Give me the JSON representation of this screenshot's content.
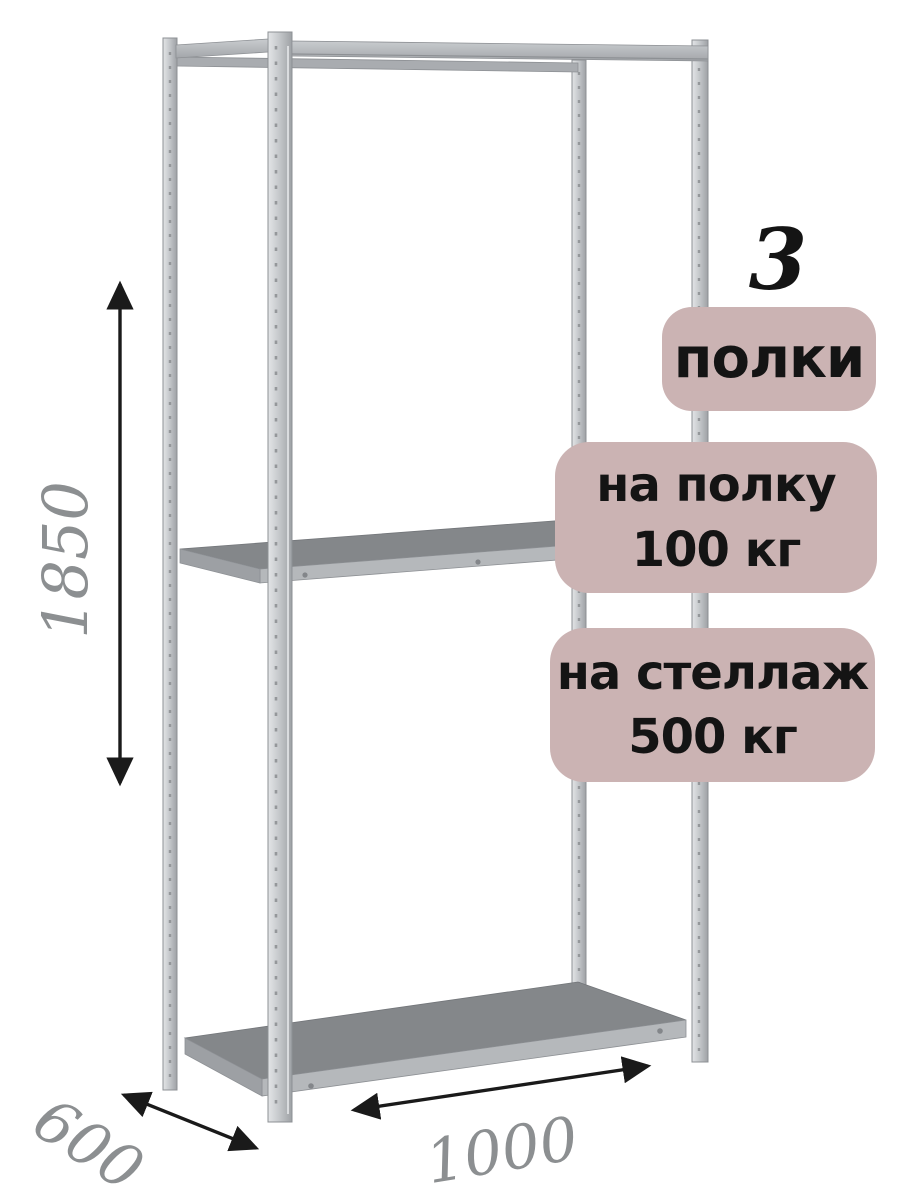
{
  "badges": {
    "count_number": "3",
    "count_label": "полки",
    "per_shelf": {
      "line1": "на полку",
      "line2": "100 кг"
    },
    "per_rack": {
      "line1": "на стеллаж",
      "line2": "500 кг"
    }
  },
  "dimensions": {
    "height_mm": "1850",
    "width_mm": "1000",
    "depth_mm": "600"
  },
  "colors": {
    "background": "#ffffff",
    "badge_bg": "#cbb3b3",
    "badge_text": "#141414",
    "count_number_color": "#141414",
    "dimension_text": "#8c8f91",
    "arrow": "#1a1a1a",
    "metal_light": "#d7d9db",
    "metal_mid": "#b7babd",
    "metal_dark": "#979a9d",
    "shelf_top": "#84878a",
    "shelf_front": "#b5b8bb"
  }
}
